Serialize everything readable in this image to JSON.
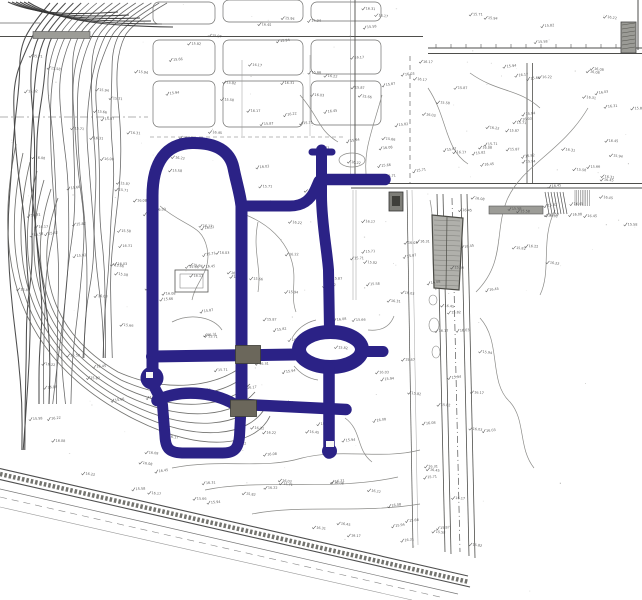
{
  "document": {
    "kind": "scanned topographic site plan",
    "description": "Scanned black-and-white survey site plan with contour lines, parcel boundaries and spot elevations; internal road network highlighted in dark blue including a loop road, central avenue, roundabout and spur roads; two grey crosswalk blocks; hatched building footprints; diagonal railway corridor along the lower edge",
    "visible_title": "",
    "text_legible": false
  },
  "map": {
    "highlighted_network": {
      "label": "highlighted road network",
      "features": [
        "west loop road with arched north end",
        "central north-south avenue",
        "north access stub with tee cap",
        "northeast access road",
        "mid connector to east road",
        "east north-south road",
        "elliptical roundabout",
        "east stub from roundabout",
        "south spur below roundabout",
        "middle east-west road",
        "lower east-west road",
        "south loop (U-shaped)",
        "west knob widening"
      ]
    },
    "crosswalk_blocks": {
      "count": 2,
      "description": "solid grey rectangles where the central avenue crosses the two east-west roads"
    },
    "roundabout": {
      "shape": "ellipse with open centre island"
    },
    "buildings": {
      "large_hatched_building": "grey hatched rectangular footprint east of the roads",
      "small_dark_building": "small dark square footprint near east road",
      "top_right_hatched_block": "small hatched block at upper right",
      "grey_bars": 2
    },
    "terrain": {
      "west_contours": "dense wavy contour lines on steep western slope",
      "bowl_contours": "concentric contour bowls at lower west",
      "scattered_contours": "light meandering contour lines across the site"
    },
    "railway_band": "multi-line hatched railway/road corridor running diagonally along the bottom edge",
    "spot_marks": {
      "legible": false,
      "samples": [
        "16.08",
        "15.94",
        "16.22",
        "15.87",
        "16.45",
        "15.71",
        "16.03",
        "15.58",
        "16.31",
        "15.66",
        "16.17",
        "15.82"
      ]
    }
  },
  "colors": {
    "paper": "#fcfcfa",
    "highlight_blue": "#2b2286",
    "crosswalk_grey": "#6b675b",
    "line_dark": "#4e4e4b",
    "line_light": "#8b8b88",
    "contour": "#454545",
    "building_fill": "#b0b0ab",
    "building_line": "#6a6a65",
    "bar_grey": "#9c9c97",
    "mark_grey": "#4c4c4c"
  }
}
